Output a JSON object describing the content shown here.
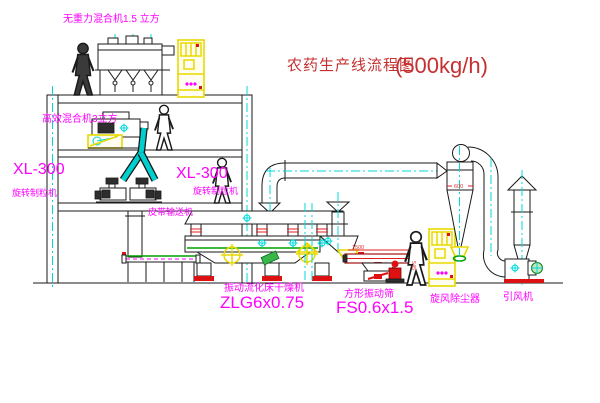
{
  "title": {
    "name": "农药生产线流程图",
    "capacity": "(500kg/h)"
  },
  "equipment_labels": {
    "gravity_mixer": "无重力混合机1.5 立方",
    "high_efficiency_mixer": "高效混合机3立方",
    "granulator_left_model": "XL-300",
    "granulator_left_name": "旋转制粒机",
    "granulator_center_model": "XL-300",
    "granulator_center_name": "旋转制粒机",
    "belt_conveyor": "皮带输送机",
    "fluid_bed_dryer_name": "振动流化床干燥机",
    "fluid_bed_dryer_model": "ZLG6x0.75",
    "vibrating_screen_name": "方形振动筛",
    "vibrating_screen_model": "FS0.6x1.5",
    "cyclone_dust_collector": "旋风除尘器",
    "induced_draft_fan": "引风机"
  },
  "dimensions": {
    "screen_length": "1500",
    "screen_height": "545",
    "cyclone_diameter": "600"
  },
  "colors": {
    "label_magenta": "#ff00ff",
    "title_red": "#c53030",
    "centerline_cyan": "#00d8d8",
    "equipment_yellow": "#e8d800",
    "deck_green": "#00a000",
    "base_red": "#dd1111",
    "line_black": "#1a1a1a"
  }
}
